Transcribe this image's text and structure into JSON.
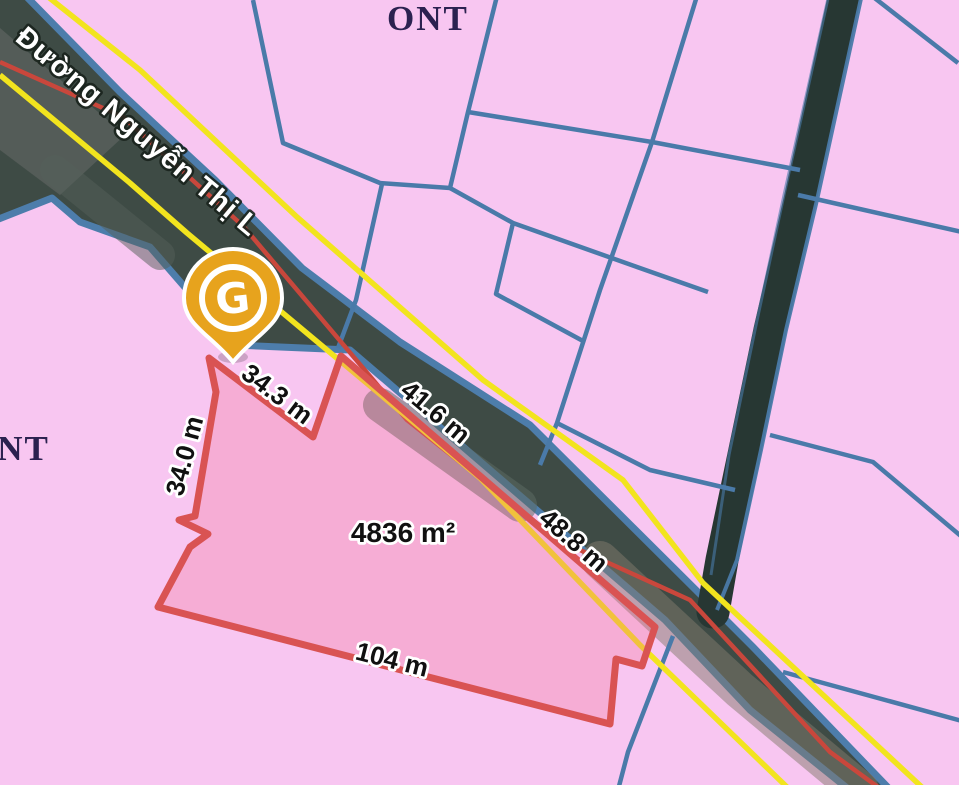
{
  "map": {
    "zone_label_top": "ONT",
    "zone_label_left": "ONT",
    "road_name": "Đường Nguyễn Thị L",
    "marker_letter": "G",
    "parcel": {
      "area": "4836 m²",
      "edges": [
        {
          "side": "upper-left-diagonal",
          "label": "34.3 m"
        },
        {
          "side": "road-upper",
          "label": "41.6 m"
        },
        {
          "side": "road-lower",
          "label": "48.8 m"
        },
        {
          "side": "bottom",
          "label": "104 m"
        },
        {
          "side": "left",
          "label": "34.0 m"
        }
      ]
    },
    "colors": {
      "background_pink": "#f8c6f1",
      "cadastral_line_blue": "#4a7aa9",
      "plot_outline_red": "#d95353",
      "plot_fill_red": "#ef6a8c",
      "planning_line_yellow": "#f2e41e",
      "road_centerline_red": "#c9473c",
      "road_surface_dark": "#3e4b45",
      "canal_strip_dark": "#273733",
      "marker_gold": "#e7a31d"
    }
  }
}
